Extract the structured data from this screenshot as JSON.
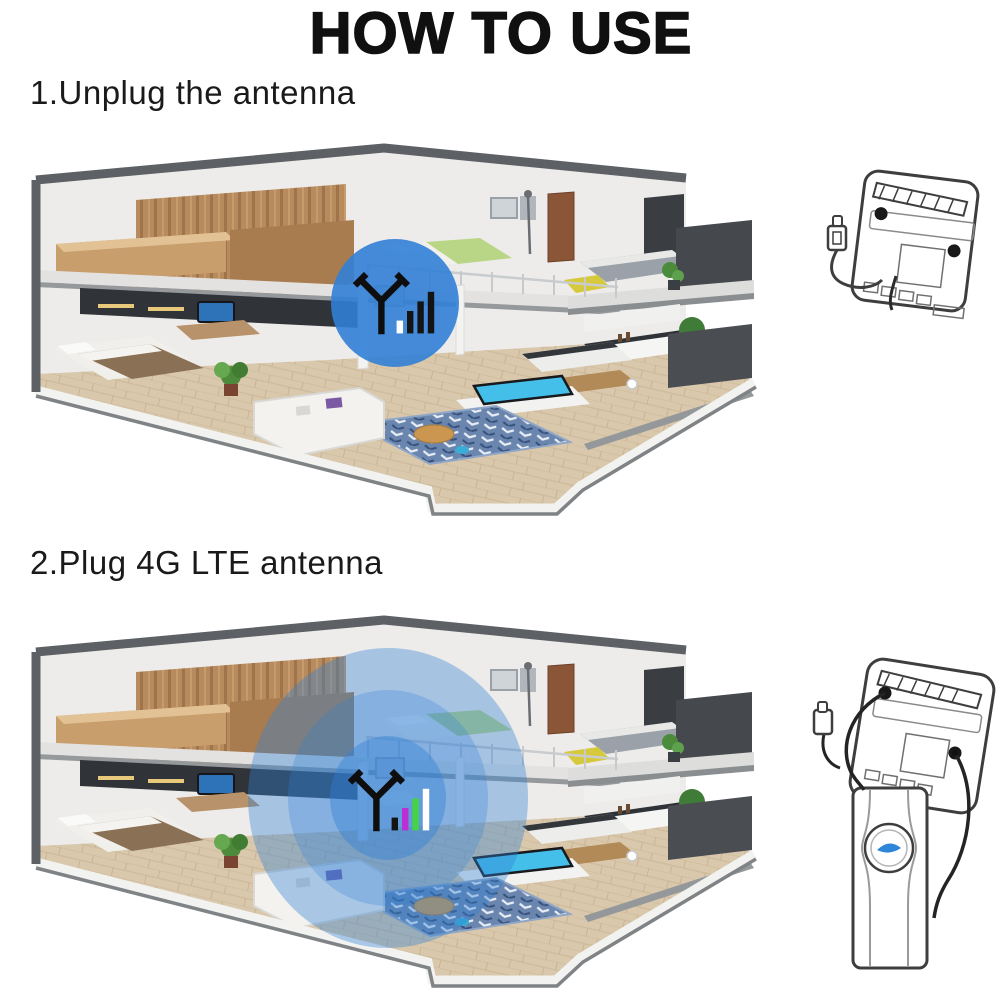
{
  "title": "HOW TO USE",
  "steps": [
    {
      "label": "1.Unplug the antenna",
      "coverage_style": "single-small-circle",
      "signal_bar_colors": [
        "#ffffff",
        "#141414",
        "#141414",
        "#141414"
      ]
    },
    {
      "label": "2.Plug 4G LTE antenna",
      "coverage_style": "large-concentric-rings",
      "signal_bar_colors": [
        "#141414",
        "#bb2fd4",
        "#44d344",
        "#ffffff"
      ]
    }
  ],
  "colors": {
    "background": "#ffffff",
    "text": "#111111",
    "coverage_blue": "#3180d6",
    "house_shell_gray": "#5d6165",
    "line_art": "#3e3e3e",
    "antenna_logo_blue": "#2f86d8"
  },
  "icons": {
    "antenna": "antenna-signal-icon",
    "coverage": "wifi-coverage-circle",
    "router": "router-back-icon",
    "external_antenna": "external-antenna-panel-icon"
  }
}
